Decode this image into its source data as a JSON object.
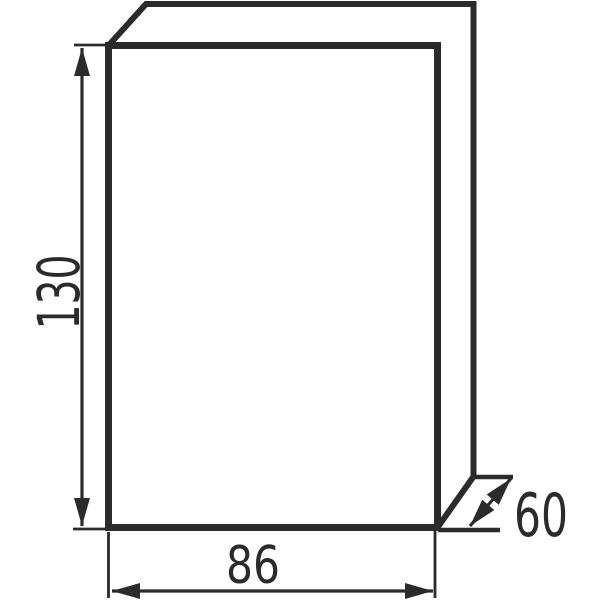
{
  "figure": {
    "background_color": "#ffffff",
    "line_color": "#2b2b2b",
    "dimension_labels": {
      "height": "130",
      "width": "86",
      "depth": "60"
    }
  }
}
